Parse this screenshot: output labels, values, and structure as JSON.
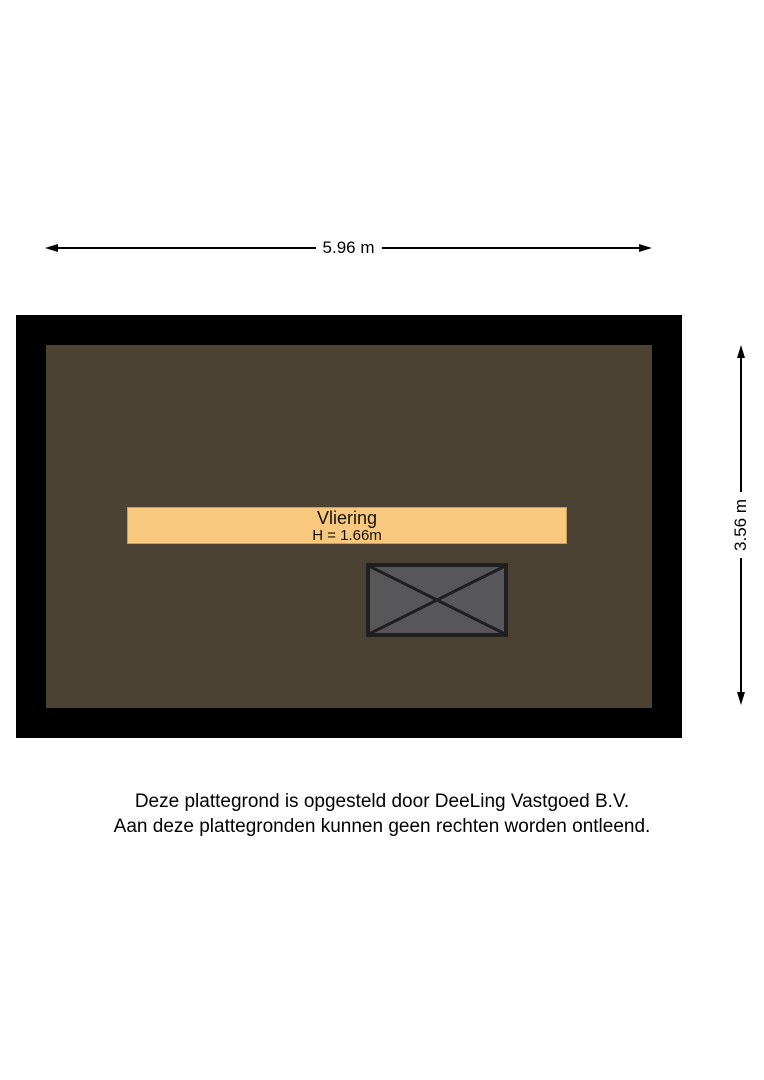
{
  "dimensions": {
    "width": {
      "label": "5.96 m"
    },
    "height": {
      "label": "3.56 m"
    }
  },
  "room": {
    "name": "Vliering",
    "height_note": "H = 1.66m"
  },
  "colors": {
    "wall": "#000000",
    "floor": "#4b4233",
    "loft_bar_fill": "#f7c87d",
    "loft_bar_border": "#c99f56",
    "hatch_fill": "#57575a",
    "hatch_stroke": "#1f1f22",
    "dimension_line": "#000000",
    "text": "#000000"
  },
  "footer": {
    "line1": "Deze plattegrond is opgesteld door DeeLing Vastgoed B.V.",
    "line2": "Aan deze plattegronden kunnen geen rechten worden ontleend."
  }
}
